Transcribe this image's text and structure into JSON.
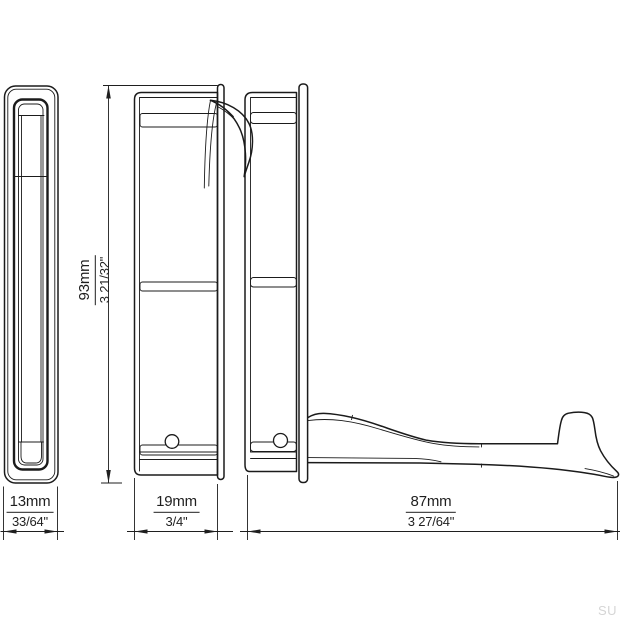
{
  "drawing": {
    "type": "technical-dimension-drawing",
    "subject": "folding wall hook, three orthographic views",
    "dims": {
      "width": {
        "mm": "13mm",
        "inch": "33/64\""
      },
      "depth": {
        "mm": "19mm",
        "inch": "3/4\""
      },
      "height": {
        "mm": "93mm",
        "inch": "3 21/32\""
      },
      "reach": {
        "mm": "87mm",
        "inch": "3 27/64\""
      }
    },
    "watermark": "SU",
    "colors": {
      "line": "#1b1b1b",
      "dimension_line": "#1f1f1f",
      "watermark": "#d5d5d5",
      "background": "#ffffff"
    }
  }
}
